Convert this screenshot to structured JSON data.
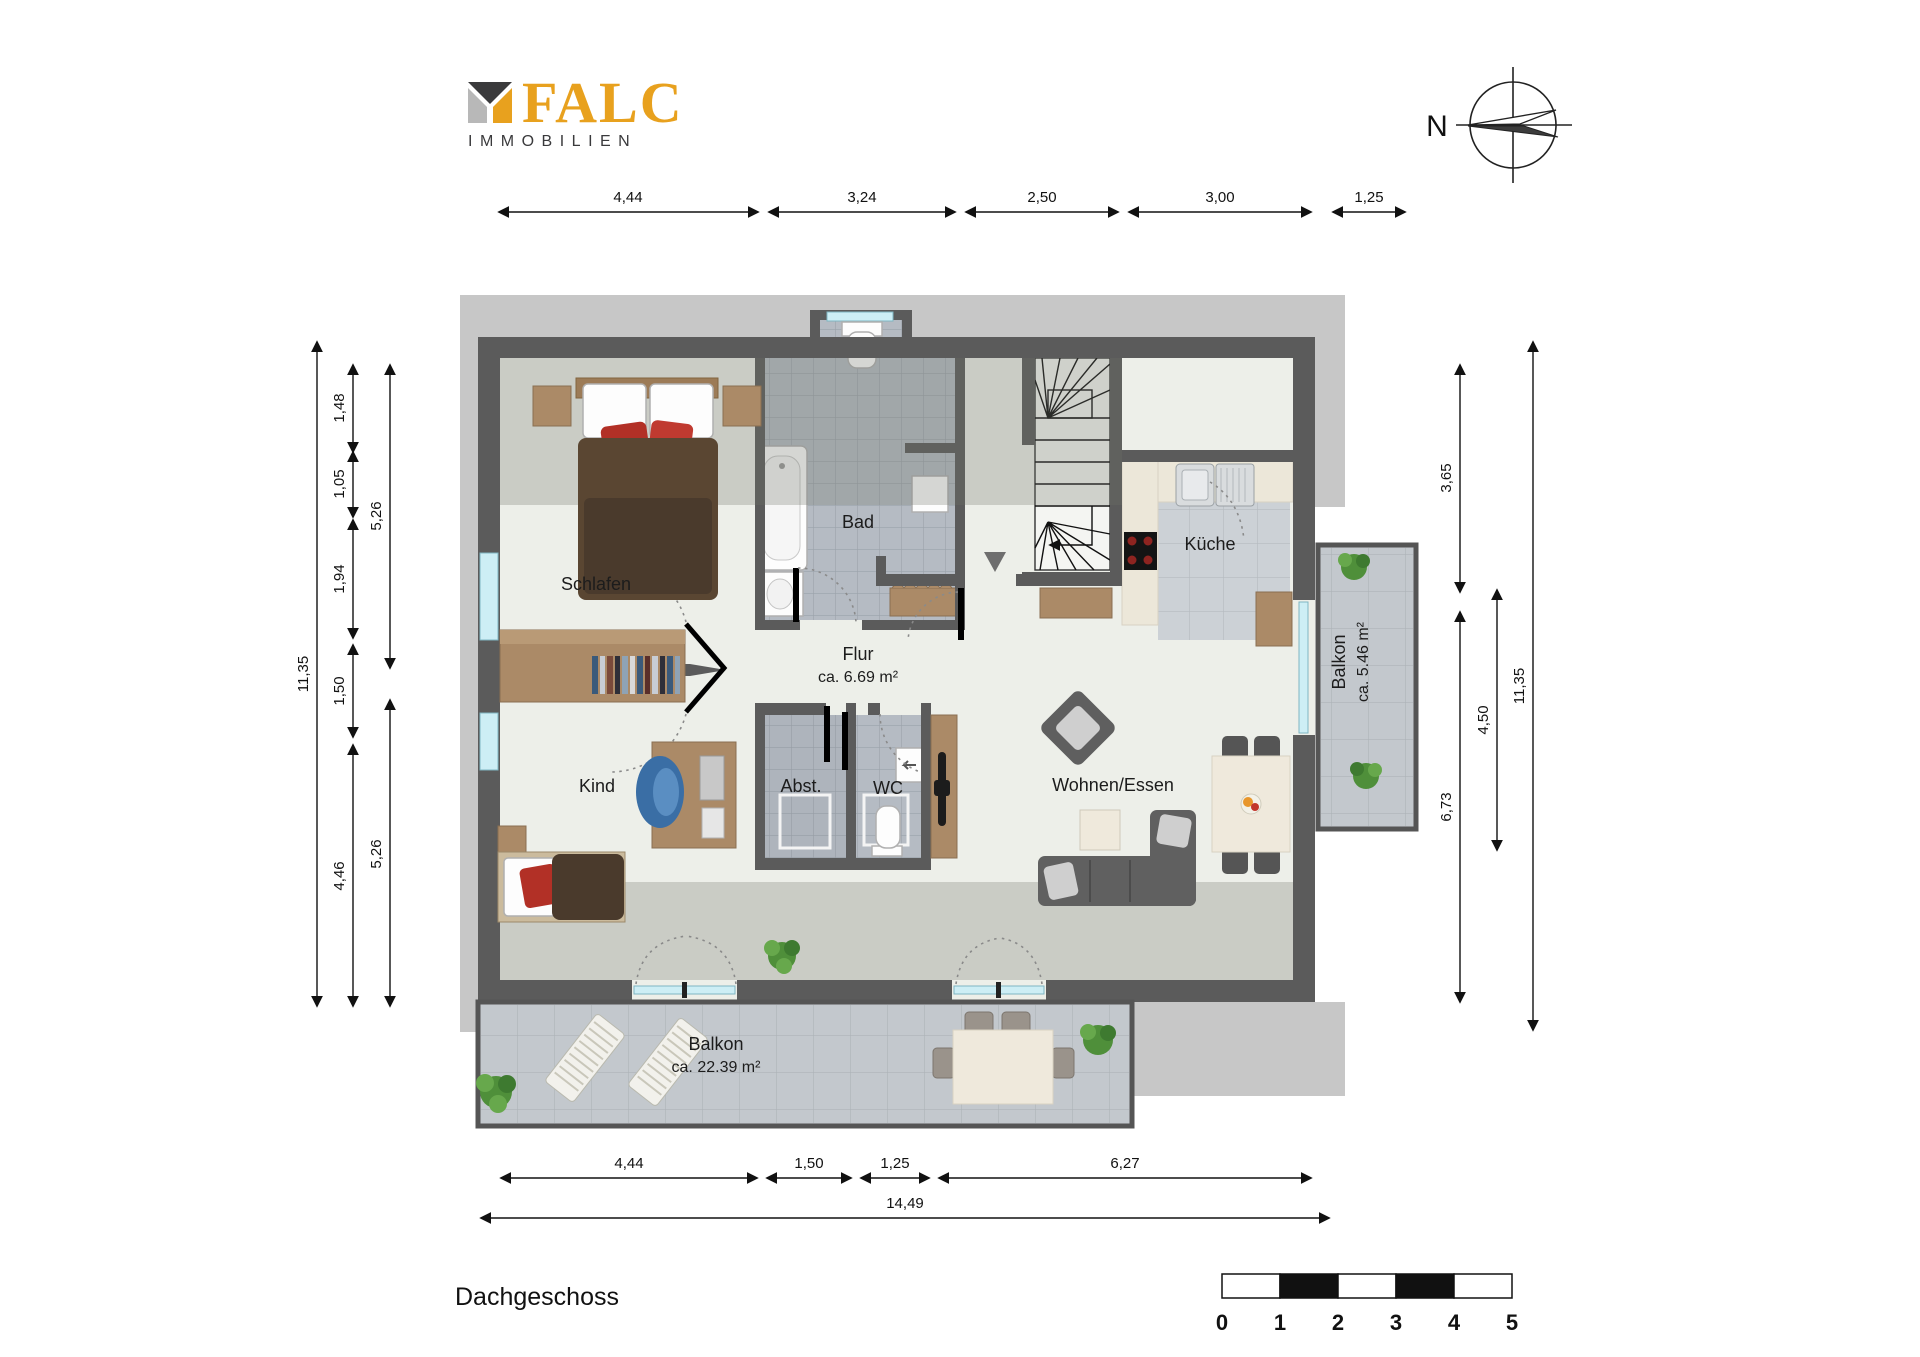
{
  "brand": {
    "name": "FALC",
    "subtitle": "IMMOBILIEN",
    "accent_color": "#e8a11e",
    "dark_color": "#3a3a3c",
    "light_color": "#b8b8b8"
  },
  "compass": {
    "north_label": "N"
  },
  "floor_title": "Dachgeschoss",
  "rooms": {
    "schlafen": {
      "label": "Schlafen"
    },
    "bad": {
      "label": "Bad"
    },
    "kueche": {
      "label": "Küche"
    },
    "flur": {
      "label": "Flur",
      "area": "ca. 6.69 m²"
    },
    "kind": {
      "label": "Kind"
    },
    "abst": {
      "label": "Abst."
    },
    "wc": {
      "label": "WC"
    },
    "wohnen": {
      "label": "Wohnen/Essen"
    },
    "balkon_klein": {
      "label": "Balkon",
      "area": "ca. 5.46 m²"
    },
    "balkon_gross": {
      "label": "Balkon",
      "area": "ca. 22.39 m²"
    }
  },
  "dimensions": {
    "top": [
      "4,44",
      "3,24",
      "2,50",
      "3,00",
      "1,25"
    ],
    "bottom": [
      "4,44",
      "1,50",
      "1,25",
      "6,27"
    ],
    "bottom_total": "14,49",
    "left": {
      "overall": "11,35",
      "chain": [
        "1,48",
        "1,05",
        "1,94",
        "1,50",
        "4,46"
      ],
      "inner": [
        "5,26",
        "5,26"
      ]
    },
    "right": {
      "overall": "11,35",
      "inner_chain": [
        "3,65",
        "6,73"
      ],
      "middle": "4,50"
    }
  },
  "scale_bar": {
    "ticks": [
      "0",
      "1",
      "2",
      "3",
      "4",
      "5"
    ]
  },
  "colors": {
    "wall": "#5b5b5b",
    "roof_band": "#c7c7c7",
    "floor": "#edefe9",
    "tile_bath": "#b5bbc3",
    "tile_balcony": "#c3c8cd",
    "kitchen_counter": "#ece7d9",
    "wood": "#ab8a67",
    "accent_red": "#b23026"
  }
}
